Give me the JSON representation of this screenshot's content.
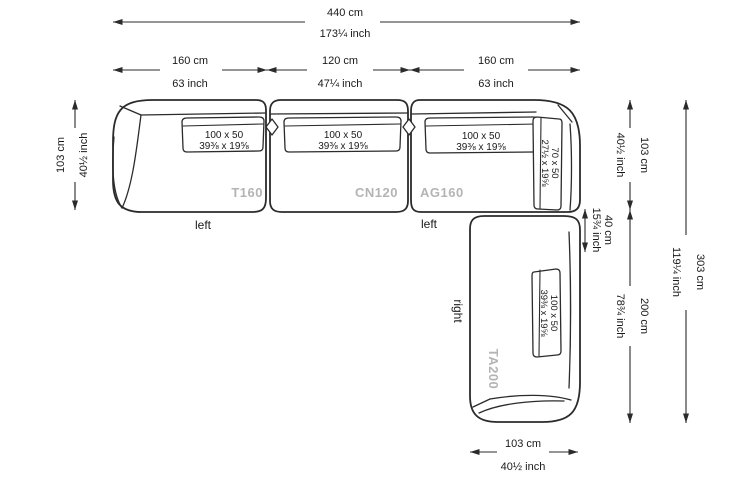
{
  "diagram_title": "sectional-sofa-dimension-drawing",
  "dims": {
    "total_width_cm": "440 cm",
    "total_width_in": "173¼ inch",
    "seg1_cm": "160 cm",
    "seg1_in": "63 inch",
    "seg2_cm": "120 cm",
    "seg2_in": "47¼ inch",
    "seg3_cm": "160 cm",
    "seg3_in": "63 inch",
    "left_depth_cm": "103 cm",
    "left_depth_in": "40½ inch",
    "right_depth_cm": "103 cm",
    "right_depth_in": "40½ inch",
    "offset_cm": "40 cm",
    "offset_in": "15¾ inch",
    "right_length_cm": "200 cm",
    "right_length_in": "78¾ inch",
    "total_height_cm": "303 cm",
    "total_height_in": "119¼ inch",
    "bottom_cm": "103 cm",
    "bottom_in": "40½ inch"
  },
  "pieces": {
    "p1": "T160",
    "p2": "CN120",
    "p3": "AG160",
    "p4": "TA200"
  },
  "orientation": {
    "left1": "left",
    "left2": "left",
    "right1": "right"
  },
  "cushion_100": {
    "size_cm": "100 x 50",
    "size_in": "39⅜ x 19⅝"
  },
  "cushion_70": {
    "size_cm": "70 x 50",
    "size_in": "27½ x 19⅝"
  },
  "colors": {
    "line": "#2b2b2b",
    "piece_label_gray": "#b4b4b4",
    "background": "#ffffff"
  }
}
